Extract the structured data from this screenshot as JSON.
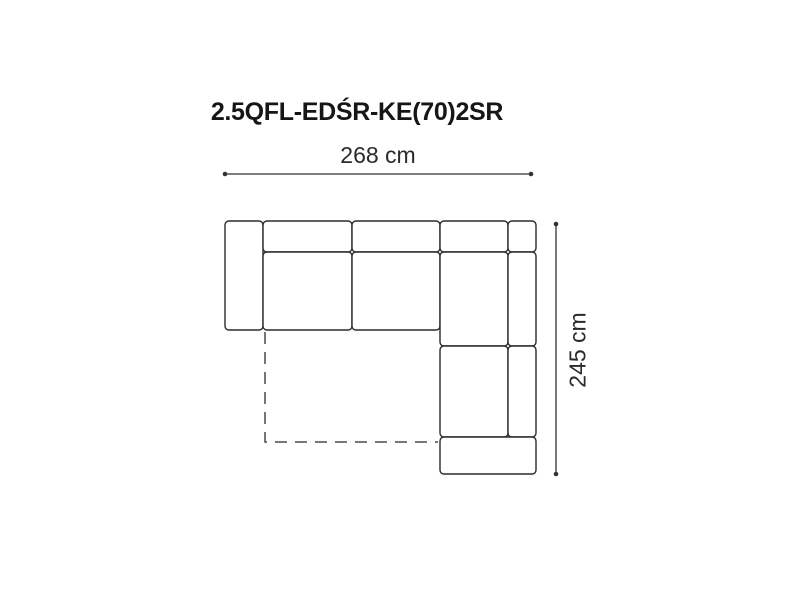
{
  "title": "2.5QFL-EDŚR-KE(70)2SR",
  "dimensions": {
    "width_label": "268 cm",
    "depth_label": "245 cm"
  },
  "colors": {
    "background": "#ffffff",
    "outline": "#2b2b2b",
    "dimension_line": "#333333",
    "dashed_line": "#4a4a4a",
    "text": "#1a1a1a"
  },
  "diagram": {
    "type": "corner-sofa-top-view",
    "outline_stroke_width": 1.4,
    "corner_radius": 4,
    "pieces": [
      {
        "name": "left-armrest",
        "x": 225,
        "y": 221,
        "w": 38,
        "h": 109
      },
      {
        "name": "backrest-1",
        "x": 263,
        "y": 221,
        "w": 89,
        "h": 31
      },
      {
        "name": "backrest-2",
        "x": 352,
        "y": 221,
        "w": 88,
        "h": 31
      },
      {
        "name": "seat-1",
        "x": 263,
        "y": 252,
        "w": 89,
        "h": 78
      },
      {
        "name": "seat-2",
        "x": 352,
        "y": 252,
        "w": 88,
        "h": 78
      },
      {
        "name": "corner-backrest",
        "x": 440,
        "y": 221,
        "w": 68,
        "h": 31
      },
      {
        "name": "corner-side-piece",
        "x": 508,
        "y": 221,
        "w": 28,
        "h": 31
      },
      {
        "name": "corner-seat",
        "x": 440,
        "y": 252,
        "w": 68,
        "h": 94
      },
      {
        "name": "right-backrest-upper",
        "x": 508,
        "y": 252,
        "w": 28,
        "h": 94
      },
      {
        "name": "right-seat",
        "x": 440,
        "y": 346,
        "w": 68,
        "h": 91
      },
      {
        "name": "right-backrest-lower",
        "x": 508,
        "y": 346,
        "w": 28,
        "h": 91
      },
      {
        "name": "bottom-armrest",
        "x": 440,
        "y": 437,
        "w": 96,
        "h": 37
      }
    ],
    "sleeping_extension": {
      "points": [
        [
          265,
          332
        ],
        [
          265,
          442
        ],
        [
          438,
          442
        ]
      ],
      "dash": "12 8",
      "stroke_width": 1.5
    },
    "dimension_lines": [
      {
        "name": "width",
        "x1": 225,
        "y1": 174,
        "x2": 531,
        "y2": 174
      },
      {
        "name": "depth",
        "x1": 556,
        "y1": 224,
        "x2": 556,
        "y2": 474
      }
    ],
    "endpoint_dot_radius": 2.3,
    "dimension_stroke_width": 1.3
  }
}
